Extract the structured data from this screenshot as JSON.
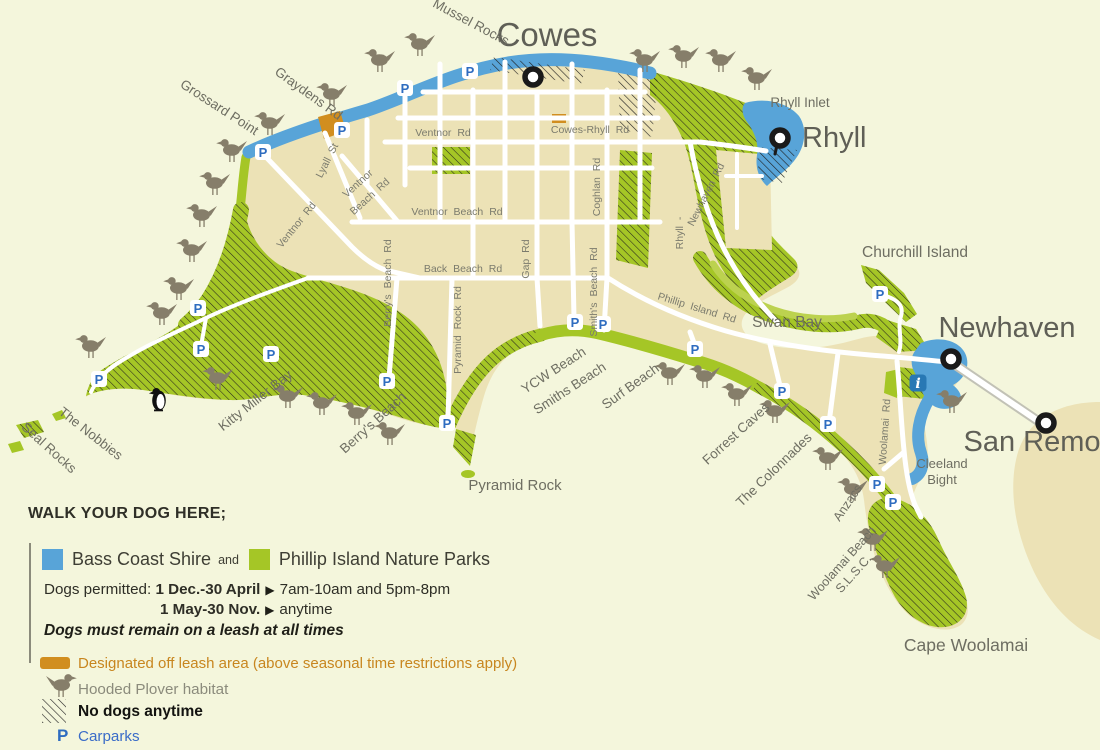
{
  "colors": {
    "sea": "#f4f6dc",
    "land": "#ece2b6",
    "nature_parks_green": "#a5c626",
    "swan_bay_light_green": "#bcd24f",
    "bass_coast_blue": "#58a4d8",
    "off_leash_orange": "#d18e1f",
    "road_label_gray": "#7b7b6d",
    "place_label_gray": "#6e6e62",
    "town_label_gray": "#5f5f56",
    "plover_brown": "#867e6a",
    "carpark_blue": "#2e6cc0",
    "info_blue": "#2878b4"
  },
  "legend": {
    "title": "WALK YOUR DOG HERE;",
    "bass_coast_label": "Bass Coast Shire",
    "and_word": "and",
    "nature_parks_label": "Phillip Island Nature Parks",
    "dogs_permitted_label": "Dogs permitted:",
    "rule1_period": "1 Dec.-30 April",
    "arrow": "▶",
    "rule1_times": "7am-10am and 5pm-8pm",
    "rule2_period": "1 May-30 Nov.",
    "rule2_times": "anytime",
    "leash_note": "Dogs must remain on a leash at all times",
    "off_leash": "Designated off leash area (above seasonal time restrictions apply)",
    "plover": "Hooded Plover habitat",
    "no_dogs": "No dogs anytime",
    "carparks_label": "Carparks",
    "p_glyph": "P",
    "info_glyph": "i"
  },
  "map": {
    "towns": [
      {
        "name": "Cowes",
        "tx": 547,
        "ty": 46,
        "mx": 533,
        "my": 77,
        "size": 33,
        "anchor": "middle"
      },
      {
        "name": "Rhyll",
        "tx": 802,
        "ty": 147,
        "mx": 780,
        "my": 138,
        "size": 29,
        "anchor": "start",
        "pin": true
      },
      {
        "name": "Newhaven",
        "tx": 1007,
        "ty": 337,
        "mx": 951,
        "my": 359,
        "size": 29,
        "anchor": "middle"
      },
      {
        "name": "San Remo",
        "tx": 1032,
        "ty": 451,
        "mx": 1046,
        "my": 423,
        "size": 29,
        "anchor": "middle"
      }
    ],
    "places": [
      {
        "name": "Mussel Rocks",
        "x": 469,
        "y": 26,
        "r": 28,
        "size": 13.5
      },
      {
        "name": "Grossard Point",
        "x": 217,
        "y": 111,
        "r": 33,
        "size": 13.5
      },
      {
        "name": "Graydens Rd",
        "x": 306,
        "y": 97,
        "r": 36,
        "size": 13.5
      },
      {
        "name": "Rhyll Inlet",
        "x": 800,
        "y": 107,
        "r": 0,
        "size": 13.5
      },
      {
        "name": "Churchill Island",
        "x": 915,
        "y": 257,
        "r": 0,
        "size": 15.5
      },
      {
        "name": "Swan Bay",
        "x": 787,
        "y": 327,
        "r": 0,
        "size": 15.5
      },
      {
        "name": "The Nobbies",
        "x": 88,
        "y": 437,
        "r": 38,
        "size": 13.5
      },
      {
        "name": "Seal Rocks",
        "x": 46,
        "y": 451,
        "r": 42,
        "size": 13.5
      },
      {
        "name": "Kitty Miller Bay",
        "x": 258,
        "y": 404,
        "r": -38,
        "size": 13.5
      },
      {
        "name": "Berry's Beach",
        "x": 376,
        "y": 426,
        "r": -42,
        "size": 13.5
      },
      {
        "name": "Pyramid Rock",
        "x": 515,
        "y": 490,
        "r": 0,
        "size": 15
      },
      {
        "name": "YCW Beach",
        "x": 556,
        "y": 374,
        "r": -33,
        "size": 13.5
      },
      {
        "name": "Smiths Beach",
        "x": 572,
        "y": 392,
        "r": -33,
        "size": 13.5
      },
      {
        "name": "Surf Beach",
        "x": 633,
        "y": 390,
        "r": -36,
        "size": 13.5
      },
      {
        "name": "Forrest Caves",
        "x": 739,
        "y": 437,
        "r": -42,
        "size": 13.5
      },
      {
        "name": "The Colonnades",
        "x": 777,
        "y": 473,
        "r": -44,
        "size": 13.5
      },
      {
        "name": "Anzacs",
        "x": 851,
        "y": 505,
        "r": -56,
        "size": 12.5
      },
      {
        "name": "Woolamai Beach S.L.S.C.",
        "lines": [
          "Woolamai Beach",
          "S.L.S.C."
        ],
        "x": 845,
        "y": 566,
        "r": -48,
        "size": 12.5
      },
      {
        "name": "Cape Woolamai",
        "x": 966,
        "y": 651,
        "r": 0,
        "size": 17.5
      },
      {
        "name": "Cleeland Bight",
        "lines": [
          "Cleeland",
          "Bight"
        ],
        "x": 942,
        "y": 468,
        "r": 0,
        "size": 13
      }
    ],
    "road_labels": [
      {
        "name": "Ventnor Rd",
        "x": 443,
        "y": 136,
        "r": 0
      },
      {
        "name": "Cowes-Rhyll Rd",
        "x": 590,
        "y": 133,
        "r": 0
      },
      {
        "name": "Lyall St",
        "x": 330,
        "y": 162,
        "r": -63
      },
      {
        "name": "Ventnor",
        "x": 360,
        "y": 186,
        "r": -42
      },
      {
        "name": "Beach Rd",
        "x": 372,
        "y": 199,
        "r": -42
      },
      {
        "name": "Ventnor Rd",
        "x": 299,
        "y": 227,
        "r": -51
      },
      {
        "name": "Ventnor Beach Rd",
        "x": 457,
        "y": 215,
        "r": 0
      },
      {
        "name": "Back Beach Rd",
        "x": 463,
        "y": 272,
        "r": 0
      },
      {
        "name": "Berry's Beach Rd",
        "x": 391,
        "y": 283,
        "r": -90
      },
      {
        "name": "Pyramid Rock Rd",
        "x": 461,
        "y": 330,
        "r": -90
      },
      {
        "name": "Gap Rd",
        "x": 529,
        "y": 259,
        "r": -90
      },
      {
        "name": "Smith's Beach Rd",
        "x": 597,
        "y": 292,
        "r": -90
      },
      {
        "name": "Coghlan Rd",
        "x": 600,
        "y": 187,
        "r": -90
      },
      {
        "name": "Newhaven Rd",
        "x": 709,
        "y": 196,
        "r": -63
      },
      {
        "name": "Rhyll -",
        "x": 683,
        "y": 233,
        "r": -90
      },
      {
        "name": "Phillip Island Rd",
        "x": 696,
        "y": 311,
        "r": 17
      },
      {
        "name": "Woolamai Rd",
        "x": 888,
        "y": 432,
        "r": -86
      }
    ],
    "carparks": [
      [
        405,
        88
      ],
      [
        470,
        71
      ],
      [
        342,
        130
      ],
      [
        263,
        152
      ],
      [
        198,
        308
      ],
      [
        201,
        349
      ],
      [
        271,
        354
      ],
      [
        99,
        379
      ],
      [
        387,
        381
      ],
      [
        447,
        423
      ],
      [
        575,
        322
      ],
      [
        603,
        324
      ],
      [
        695,
        349
      ],
      [
        782,
        391
      ],
      [
        828,
        424
      ],
      [
        877,
        484
      ],
      [
        893,
        502
      ],
      [
        880,
        294
      ]
    ],
    "birds": [
      [
        380,
        72
      ],
      [
        420,
        56
      ],
      [
        332,
        106
      ],
      [
        270,
        135
      ],
      [
        232,
        162
      ],
      [
        645,
        72
      ],
      [
        684,
        68
      ],
      [
        721,
        72
      ],
      [
        757,
        90
      ],
      [
        215,
        195
      ],
      [
        202,
        227
      ],
      [
        192,
        262
      ],
      [
        179,
        300
      ],
      [
        162,
        325
      ],
      [
        91,
        358
      ],
      [
        218,
        390
      ],
      [
        288,
        408
      ],
      [
        322,
        415
      ],
      [
        357,
        425
      ],
      [
        390,
        445
      ],
      [
        670,
        385
      ],
      [
        705,
        388
      ],
      [
        737,
        406
      ],
      [
        775,
        423
      ],
      [
        828,
        470
      ],
      [
        853,
        501
      ],
      [
        952,
        413
      ],
      [
        873,
        551
      ],
      [
        885,
        578
      ]
    ],
    "penguin": [
      159,
      411
    ],
    "info_marker": {
      "x": 918,
      "y": 383
    }
  }
}
